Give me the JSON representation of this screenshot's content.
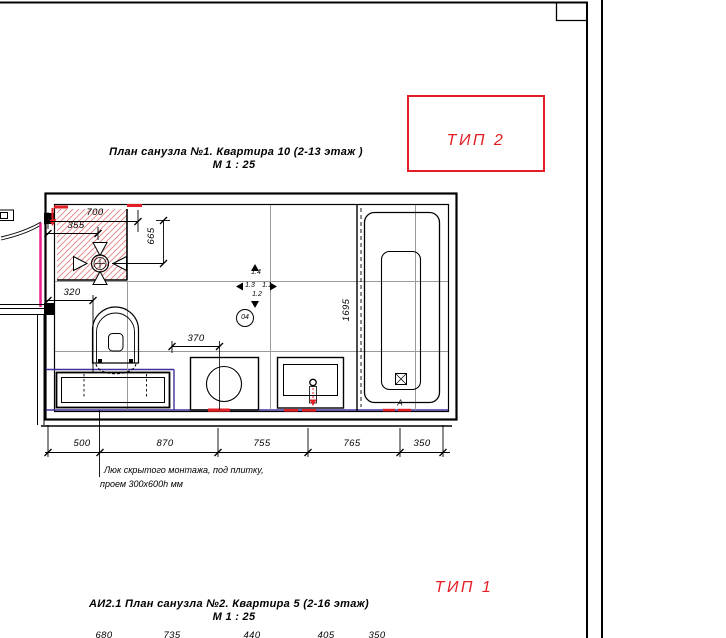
{
  "titles": {
    "plan1_title": "План санузла №1. Квартира 10 (2-13 этаж )",
    "plan1_scale": "М 1 : 25",
    "plan2_title": "АИ2.1 План санузла №2. Квартира 5 (2-16 этаж)",
    "plan2_scale": "М 1 : 25"
  },
  "type_labels": {
    "tip2": "ТИП 2",
    "tip1": "ТИП 1"
  },
  "note": {
    "line1": "Люк скрытого монтажа, под плитку,",
    "line2": "проем 300х600h мм"
  },
  "dims": {
    "w700": "700",
    "w355": "355",
    "h665": "665",
    "w320": "320",
    "w370": "370",
    "h1695": "1695",
    "bottom": [
      "500",
      "870",
      "755",
      "765",
      "350"
    ],
    "clipped": [
      "680",
      "735",
      "440",
      "405",
      "350"
    ]
  },
  "markers": {
    "view_up": "1.4",
    "view_left": "1.3",
    "view_right": "1.1",
    "view_down": "1.2",
    "detail_circle": "04",
    "section": "А"
  },
  "colors": {
    "red": "#e31e24",
    "magenta": "#ec1f8e",
    "purple": "#41309b",
    "grid": "#9a9a9a",
    "line": "#000000",
    "hatch": "#e29090"
  }
}
